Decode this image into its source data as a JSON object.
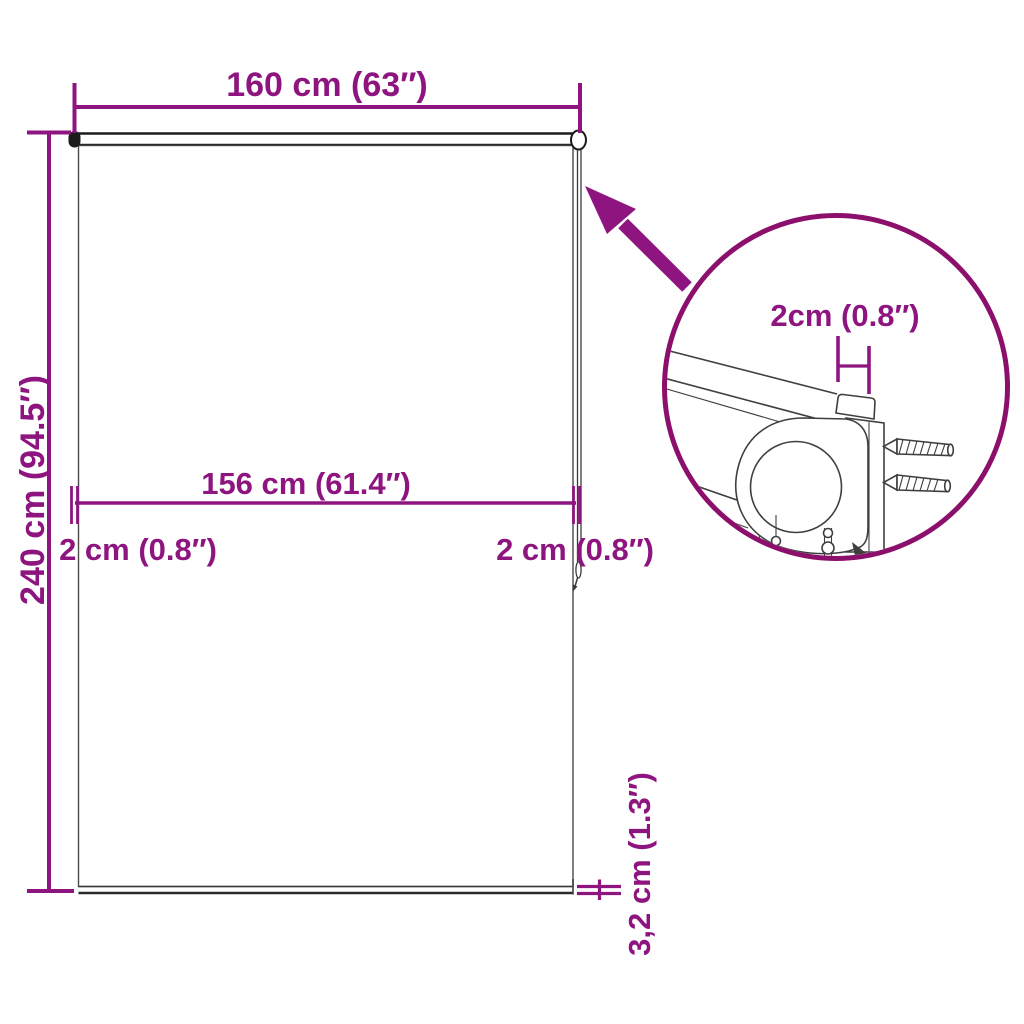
{
  "figure": {
    "type": "product-dimension-diagram",
    "subject": "roller blind with mounting bracket detail",
    "background": "#ffffff",
    "accent_color": "#8E1580",
    "detail_circle_color": "#8C0F6B",
    "outline_color": "#3f3f3f"
  },
  "dimensions": {
    "total_width": "160 cm (63″)",
    "total_height": "240 cm (94.5″)",
    "fabric_width": "156 cm (61.4″)",
    "left_gap": "2 cm (0.8″)",
    "right_gap": "2 cm (0.8″)",
    "bottom_bar": "3,2 cm (1.3″)",
    "bracket_detail": "2cm (0.8″)"
  }
}
